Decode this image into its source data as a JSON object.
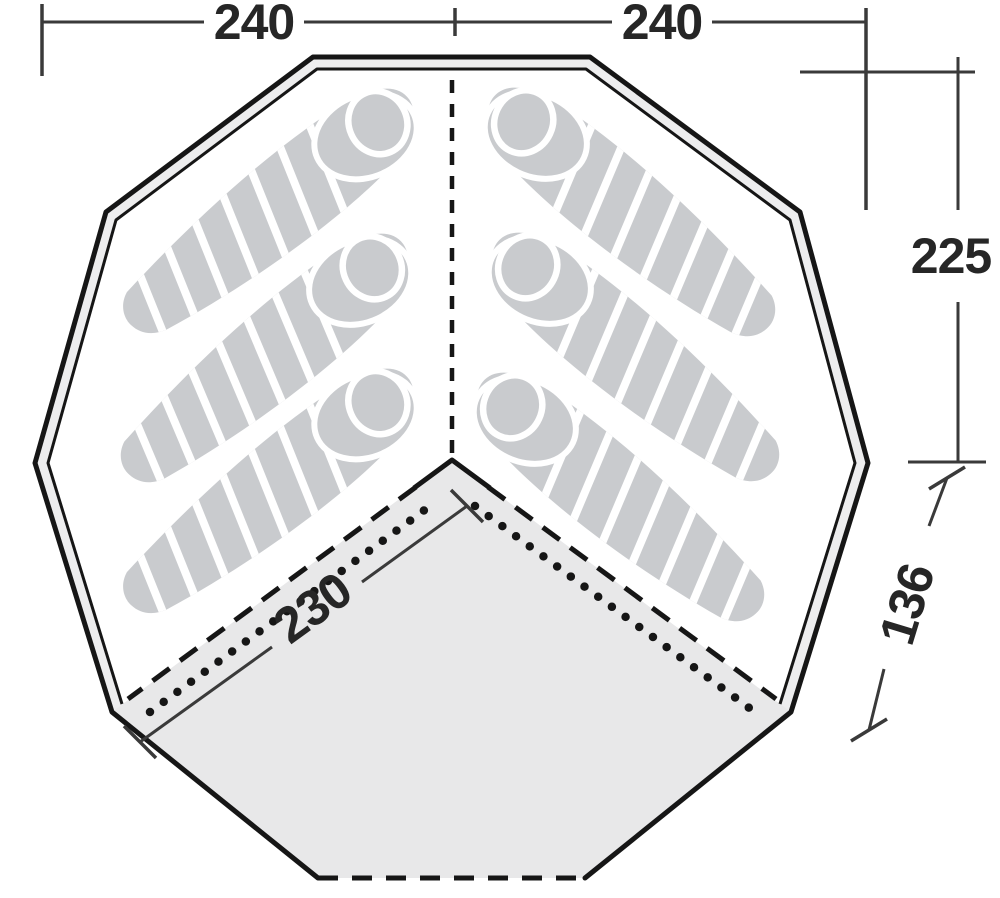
{
  "diagram": {
    "kind": "tent-floorplan",
    "dimensions": {
      "top_left": "240",
      "top_right": "240",
      "side_height": "225",
      "lower_edge": "136",
      "inner_diagonal": "230"
    },
    "sleeping_bags": {
      "count": 6,
      "left_count": 3,
      "right_count": 3
    },
    "colors": {
      "bg": "#ffffff",
      "line": "#161616",
      "dim": "#3a3a3a",
      "text": "#262626",
      "bag": "#c9cbce",
      "bag_stripe": "#ffffff",
      "area": "#e8e8e9",
      "wall_gap": "#ededee"
    }
  }
}
